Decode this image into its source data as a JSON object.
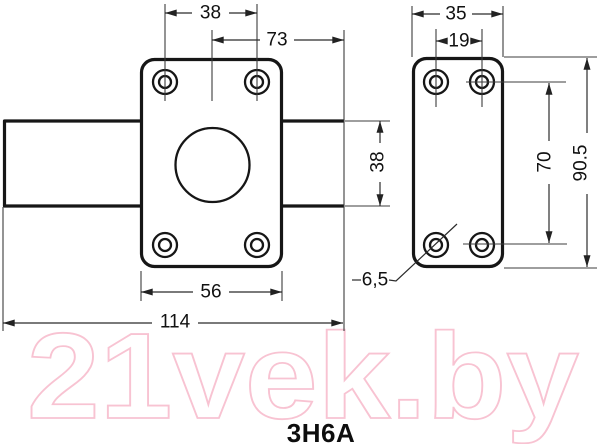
{
  "title": {
    "label": "3H6A"
  },
  "watermark": {
    "label": "21vek.by",
    "color": "#f8c3d2"
  },
  "front_view": {
    "dim_hole_spacing": "38",
    "dim_center_to_shaft_end": "73",
    "dim_shaft_height": "38",
    "dim_plate_width": "56",
    "dim_overall_length": "114"
  },
  "side_view": {
    "dim_plate_width": "35",
    "dim_hole_spacing_horizontal": "19",
    "dim_hole_spacing_vertical": "70",
    "dim_plate_height": "90.5",
    "dim_hole_diameter": "6,5"
  }
}
